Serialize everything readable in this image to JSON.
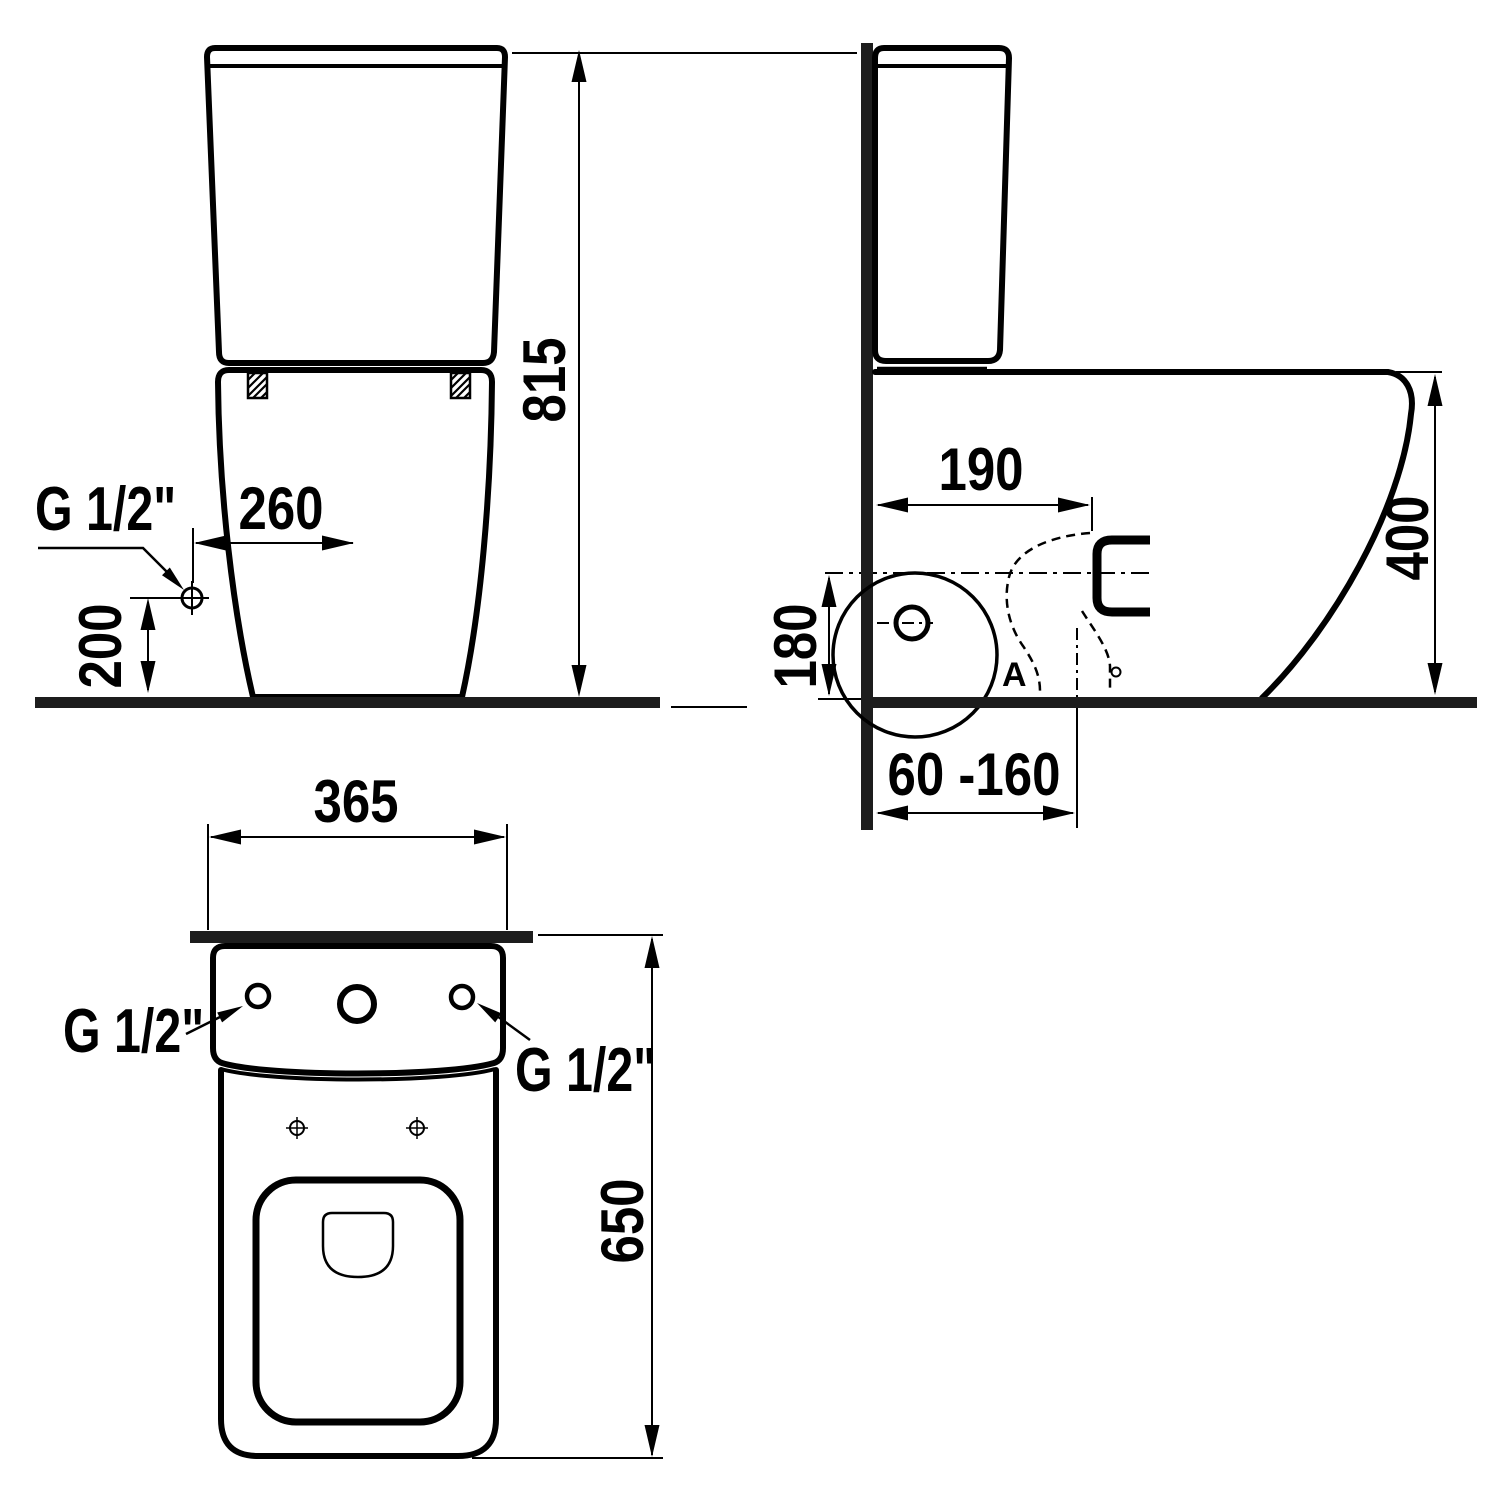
{
  "colors": {
    "ink": "#000000",
    "bar": "#1d1d1d",
    "bg": "#ffffff"
  },
  "front_view": {
    "overall_height": "815",
    "inlet_offset_from_center": "260",
    "inlet_height": "200",
    "inlet_thread": "G 1/2\""
  },
  "side_view": {
    "outlet_center_from_wall": "190",
    "rim_height": "400",
    "outlet_axis_height": "180",
    "outlet_adjust_range": "60 -160",
    "detail_marker": "A"
  },
  "plan_view": {
    "overall_width": "365",
    "overall_depth": "650",
    "inlet_thread_left": "G 1/2\"",
    "inlet_thread_right": "G 1/2\""
  }
}
